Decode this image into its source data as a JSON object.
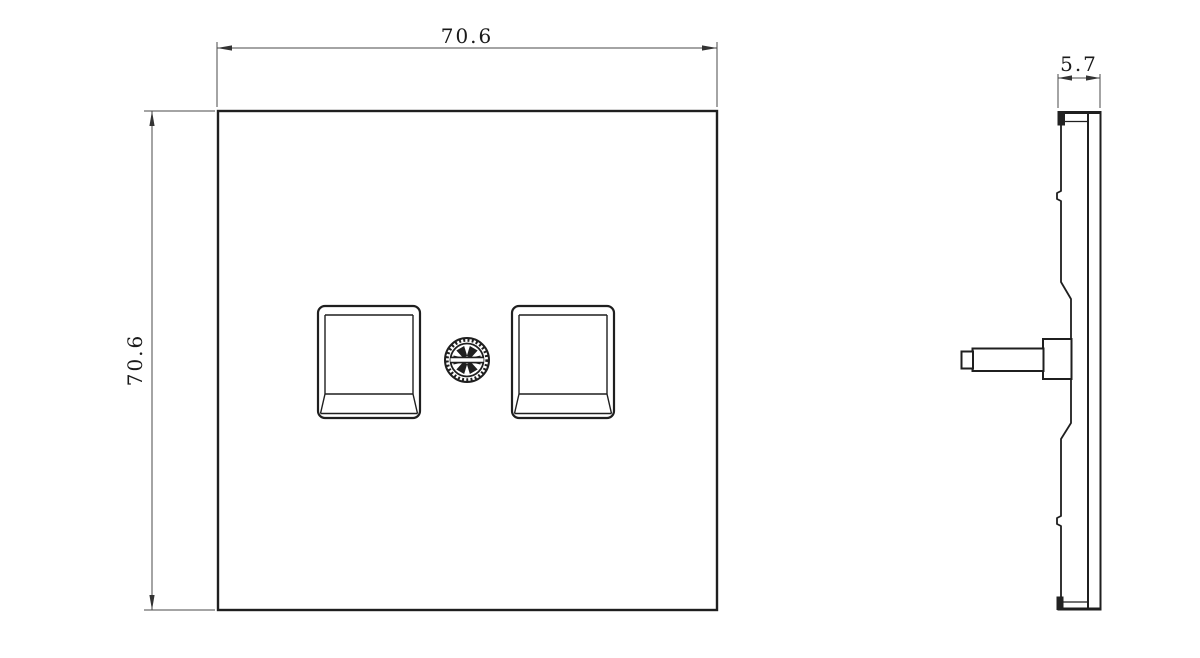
{
  "drawing": {
    "background": "#ffffff",
    "outline_color": "#1f1f1f",
    "dimension_color": "#4a4a4a"
  },
  "front_view": {
    "width_label": "70.6",
    "height_label": "70.6"
  },
  "side_view": {
    "depth_label": "5.7"
  }
}
